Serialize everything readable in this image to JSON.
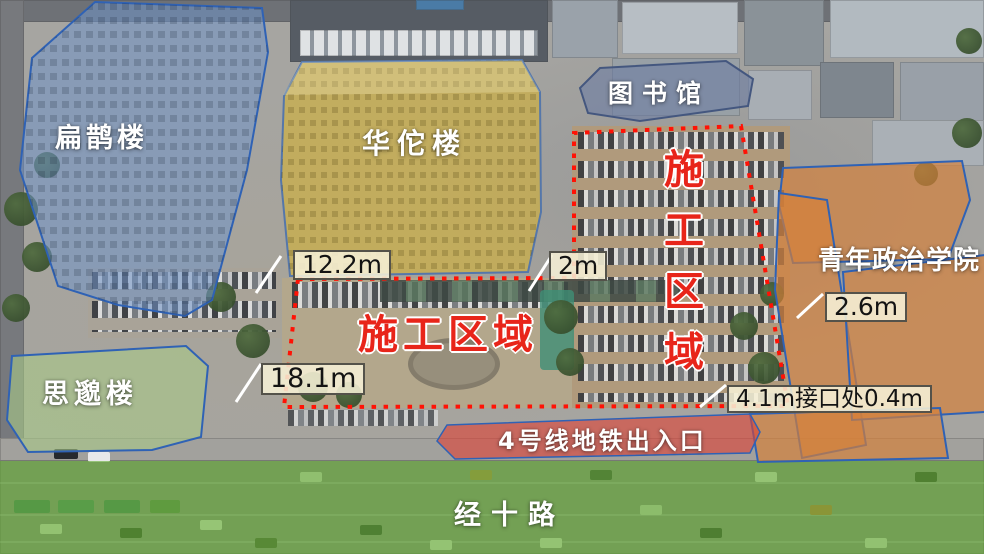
{
  "buildings": {
    "bianque": {
      "label": "扁鹊楼"
    },
    "huatuo": {
      "label": "华佗楼"
    },
    "library": {
      "label": "图书馆"
    },
    "college": {
      "label": "青年政治学院"
    },
    "simiao": {
      "label": "思邈楼"
    }
  },
  "zones": {
    "construction_main": {
      "label": "施工区域"
    },
    "construction_right": {
      "label": "施工区域"
    },
    "metro_entrance": {
      "label": "4号线地铁出入口"
    },
    "road": {
      "label": "经十路"
    }
  },
  "measurements": {
    "west_gap": {
      "label": "12.2m"
    },
    "mid_gap": {
      "label": "2m"
    },
    "east_gap": {
      "label": "2.6m"
    },
    "south_gap": {
      "label": "18.1m"
    },
    "interface": {
      "label": "4.1m接口处0.4m"
    }
  },
  "colors": {
    "boundary_red": "#ff1205",
    "zone_text_red": "#e8251a",
    "bianque_fill": "#6f94c9",
    "huatuo_fill": "#d4b237",
    "library_fill": "#6d7ea3",
    "college_fill": "#d6803a",
    "simiao_fill": "#a9c987",
    "metro_fill": "#dd4437",
    "road_fill": "#64ac34",
    "outline_blue": "#2f62b5",
    "label_box_bg": "#f6f0d6",
    "label_box_border": "#54524a"
  }
}
